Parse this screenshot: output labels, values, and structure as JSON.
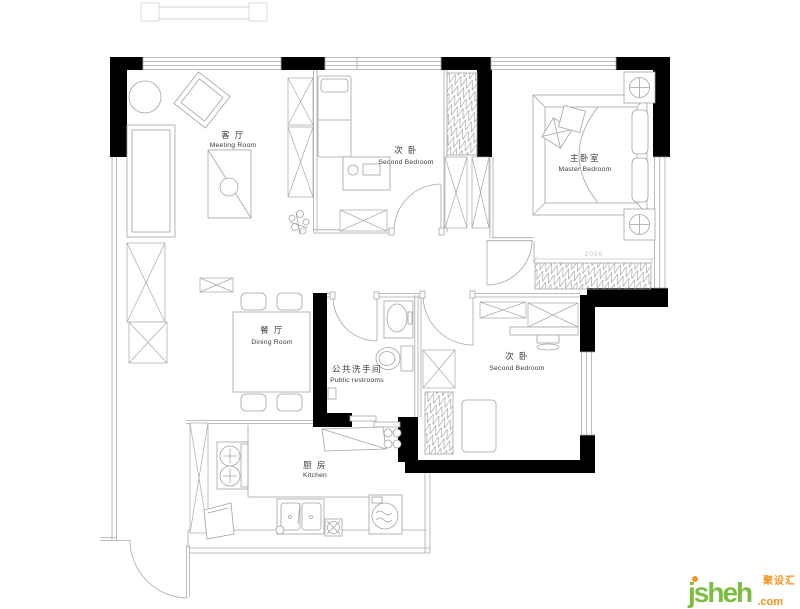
{
  "floor_plan": {
    "rooms": {
      "living": {
        "cn": "客 厅",
        "en": "Meeting Room"
      },
      "bedroom_top": {
        "cn": "次 卧",
        "en": "Second Bedroom"
      },
      "master_bedroom": {
        "cn": "主卧室",
        "en": "Master Bedroom"
      },
      "dining": {
        "cn": "餐 厅",
        "en": "Dining Room"
      },
      "bathroom": {
        "cn": "公共洗手间",
        "en": "Public restrooms"
      },
      "bedroom_right": {
        "cn": "次 卧",
        "en": "Second Bedroom"
      },
      "kitchen": {
        "cn": "厨 房",
        "en": "Kitchen"
      }
    },
    "dimension_label": "2050",
    "colors": {
      "wall": "#000000",
      "line": "#a9a9a9",
      "light_line": "#c9c9c9",
      "text": "#3c3c3c",
      "dim": "#bdbdbd"
    }
  },
  "watermark": {
    "brand": "jsheh",
    "suffix": ".com",
    "brand_cn": "聚设汇",
    "color_green": "#7cbd3f",
    "color_orange": "#f6921e"
  }
}
